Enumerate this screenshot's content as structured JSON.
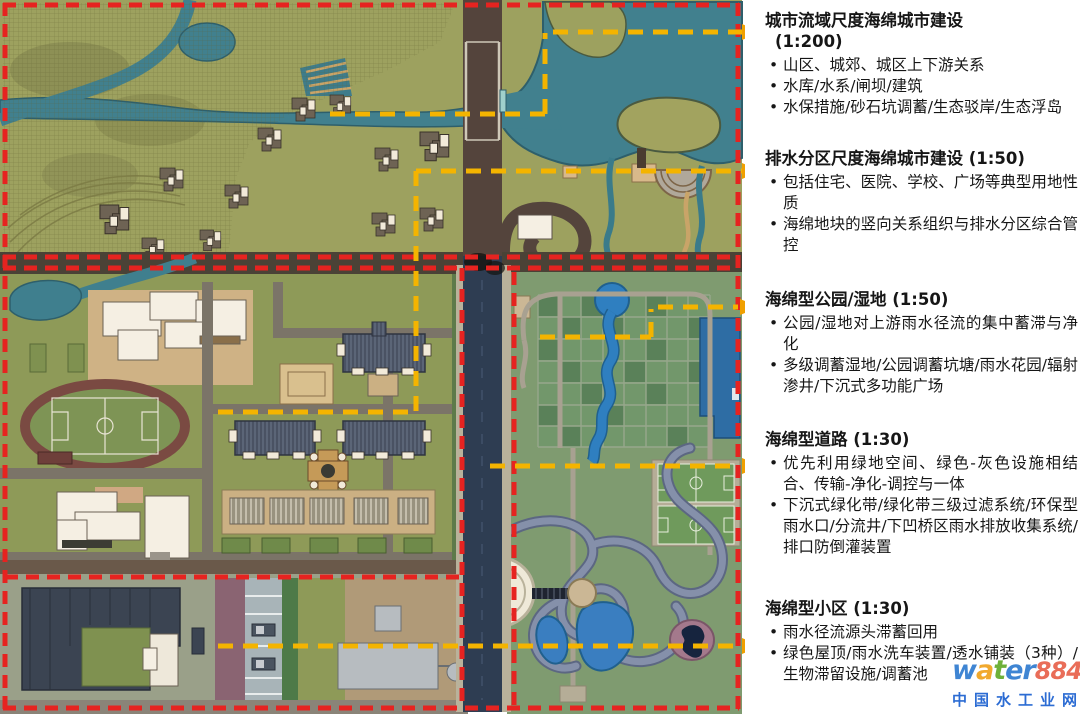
{
  "ui": {
    "bullet_char": "•"
  },
  "annotations": [
    {
      "id": "watershed-scale",
      "title_lines": [
        "城市流域尺度海绵城市建设",
        "(1:200)"
      ],
      "bullets": [
        "山区、城郊、城区上下游关系",
        "水库/水系/闸坝/建筑",
        "水保措施/砂石坑调蓄/生态驳岸/生态浮岛"
      ]
    },
    {
      "id": "drainage-zone-scale",
      "title_lines": [
        "排水分区尺度海绵城市建设 (1:50)"
      ],
      "bullets": [
        "包括住宅、医院、学校、广场等典型用地性质",
        "海绵地块的竖向关系组织与排水分区综合管控"
      ]
    },
    {
      "id": "sponge-park-wetland",
      "title_lines": [
        "海绵型公园/湿地 (1:50)"
      ],
      "bullets": [
        "公园/湿地对上游雨水径流的集中蓄滞与净化",
        "多级调蓄湿地/公园调蓄坑塘/雨水花园/辐射渗井/下沉式多功能广场"
      ]
    },
    {
      "id": "sponge-road",
      "title_lines": [
        "海绵型道路 (1:30)"
      ],
      "bullets": [
        "优先利用绿地空间、绿色-灰色设施相结合、传输-净化-调控与一体",
        "下沉式绿化带/绿化带三级过滤系统/环保型雨水口/分流井/下凹桥区雨水排放收集系统/排口防倒灌装置"
      ]
    },
    {
      "id": "sponge-residential",
      "title_lines": [
        "海绵型小区 (1:30)"
      ],
      "bullets": [
        "雨水径流源头滞蓄回用",
        "绿色屋顶/雨水洗车装置/透水铺装（3种）/生物滞留设施/调蓄池"
      ]
    }
  ],
  "watermark": {
    "brand_chars": [
      "w",
      "a",
      "t",
      "e",
      "r"
    ],
    "digits": "8848",
    "tld": ".com",
    "site_name": "中国水工业网",
    "colors": {
      "blue": "#2e7bd0",
      "orange": "#f0a21c",
      "green": "#62aa28",
      "red": "#e8604a",
      "cn_blue": "#1a5fd0"
    }
  },
  "map_colors": {
    "farmland_olive": "#9da15f",
    "campus_green": "#8e9a58",
    "park_green": "#7f9b70",
    "water_teal": "#41808e",
    "pond_blue": "#2f7fc0",
    "pool_blue": "#2e6da4",
    "road_brown": "#54443c",
    "road_asphalt": "#2e3d52",
    "road_gray": "#7b7468",
    "plaza_tan": "#cfb285",
    "building_white": "#f5efe3",
    "apartment_slate": "#5b6577",
    "track_maroon": "#7a4a42",
    "zone_border_red": "#e62320",
    "leader_yellow": "#f4b400"
  }
}
